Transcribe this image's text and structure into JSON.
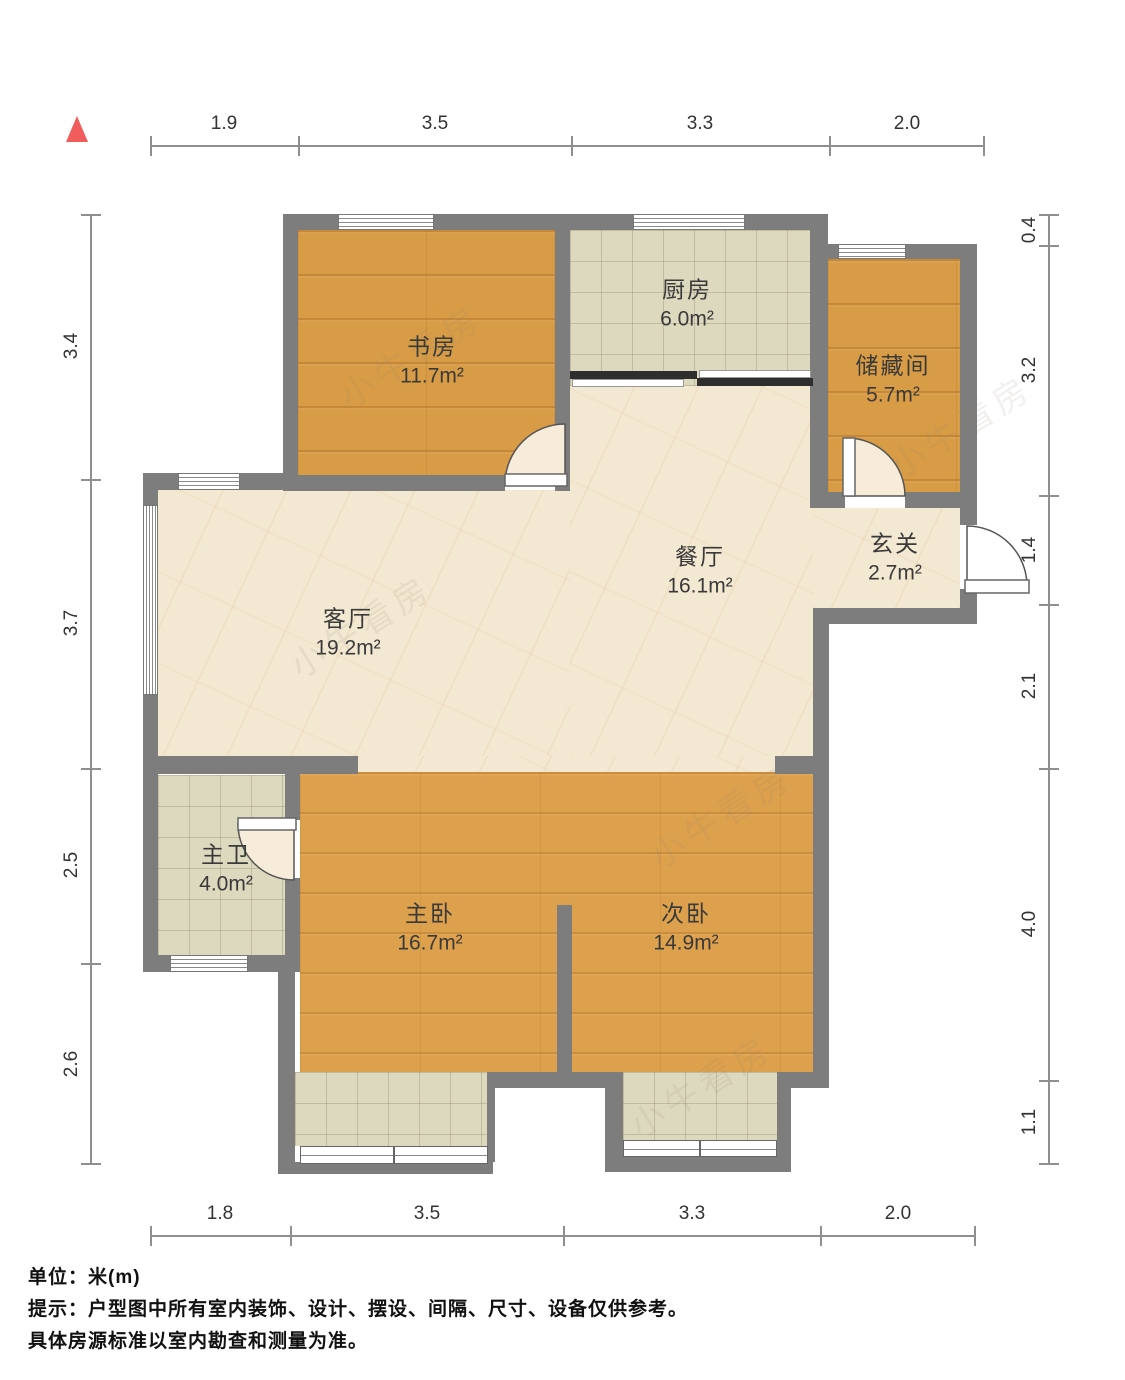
{
  "title": "户型图",
  "north_arrow": {
    "color": "#f15c5c"
  },
  "watermark": "小牛看房",
  "rooms": {
    "study": {
      "name": "书房",
      "area": "11.7m²"
    },
    "kitchen": {
      "name": "厨房",
      "area": "6.0m²"
    },
    "storage": {
      "name": "储藏间",
      "area": "5.7m²"
    },
    "dining": {
      "name": "餐厅",
      "area": "16.1m²"
    },
    "entry": {
      "name": "玄关",
      "area": "2.7m²"
    },
    "living": {
      "name": "客厅",
      "area": "19.2m²"
    },
    "master_bath": {
      "name": "主卫",
      "area": "4.0m²"
    },
    "master_bed": {
      "name": "主卧",
      "area": "16.7m²"
    },
    "second_bed": {
      "name": "次卧",
      "area": "14.9m²"
    }
  },
  "dims": {
    "top": [
      "1.9",
      "3.5",
      "3.3",
      "2.0"
    ],
    "bottom": [
      "1.8",
      "3.5",
      "3.3",
      "2.0"
    ],
    "left": [
      "3.4",
      "3.7",
      "2.5",
      "2.6"
    ],
    "right": [
      "0.4",
      "3.2",
      "1.4",
      "2.1",
      "4.0",
      "1.1"
    ]
  },
  "footer": {
    "unit": "单位：米(m)",
    "tip1": "提示：户型图中所有室内装饰、设计、摆设、间隔、尺寸、设备仅供参考。",
    "tip2": "具体房源标准以室内勘查和测量为准。"
  },
  "colors": {
    "wall": "#7d7d7d",
    "wood_floor": "#d89c46",
    "tile_floor": "#ddd9bf",
    "marble_floor": "#f3e9d2",
    "accent_north": "#f15c5c"
  }
}
